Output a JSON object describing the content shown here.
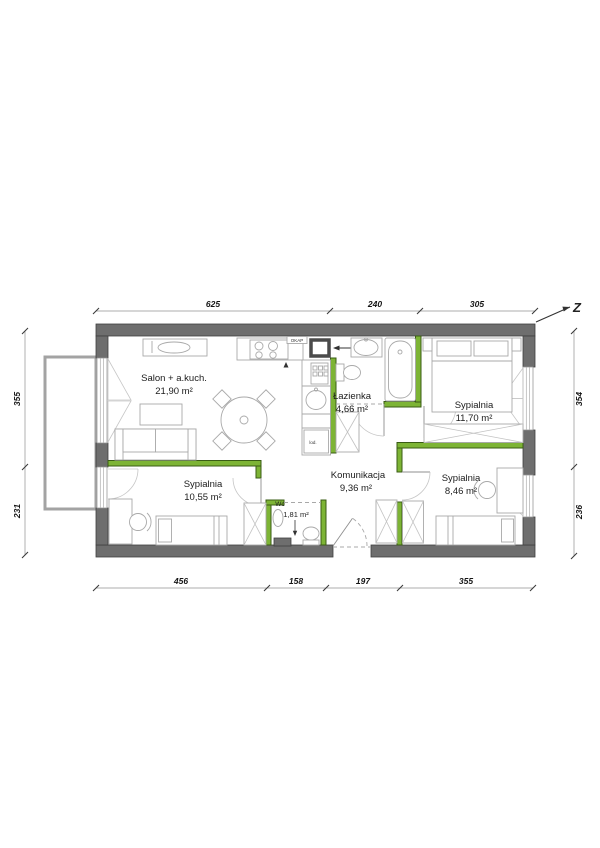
{
  "floorplan": {
    "north_label": "Z",
    "rooms": [
      {
        "name": "Salon + a.kuch.",
        "area": "21,90 m²"
      },
      {
        "name": "Łazienka",
        "area": "4,66 m²"
      },
      {
        "name": "Sypialnia",
        "area": "11,70 m²"
      },
      {
        "name": "Sypialnia",
        "area": "10,55 m²"
      },
      {
        "name": "Komunikacja",
        "area": "9,36 m²"
      },
      {
        "name": "Wc",
        "area": "1,81 m²"
      },
      {
        "name": "Sypialnia",
        "area": "8,46 m²"
      }
    ],
    "labels": {
      "kitchen_hood": "OKAP",
      "fridge": "lod."
    },
    "dimensions_cm": {
      "top": [
        "625",
        "240",
        "305"
      ],
      "bottom": [
        "456",
        "158",
        "197",
        "355"
      ],
      "left": [
        "355",
        "231"
      ],
      "right": [
        "354",
        "236"
      ]
    },
    "colors": {
      "wall": "#6e6e6e",
      "new_partition": "#7db435",
      "furniture_line": "#a9a9a9"
    }
  }
}
